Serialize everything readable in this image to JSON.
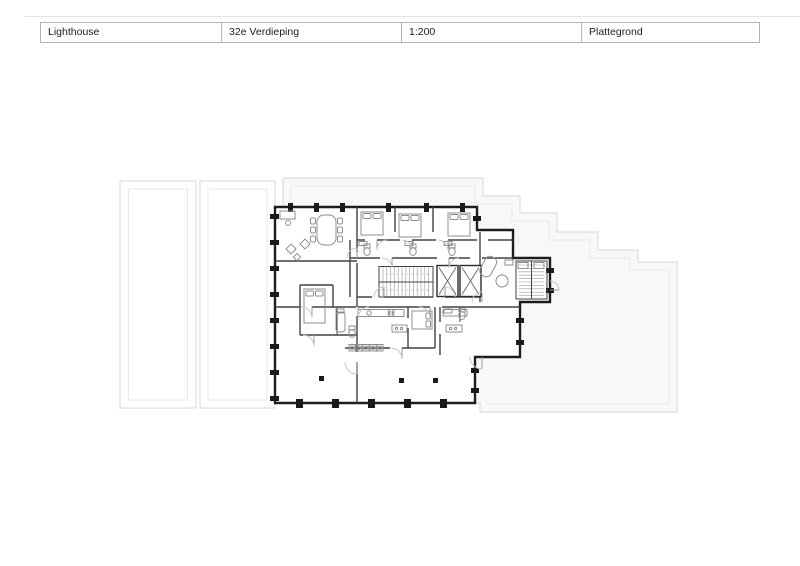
{
  "title_block": {
    "project": "Lighthouse",
    "floor": "32e Verdieping",
    "scale": "1:200",
    "drawing_type": "Plattegrond"
  },
  "colors": {
    "background": "#ffffff",
    "text": "#1c1c1c",
    "table_border": "#b5b5b5",
    "rule": "#e3e3e3",
    "terrace_line": "#dedede",
    "terrace_line_inner": "#e7e7e7",
    "terrace_fill": "#f8f8f8",
    "wall": "#1d1d1d",
    "partition": "#424242",
    "fixture": "#8f8f8f",
    "door": "#c6c6c6",
    "column": "#1a1a1a"
  }
}
